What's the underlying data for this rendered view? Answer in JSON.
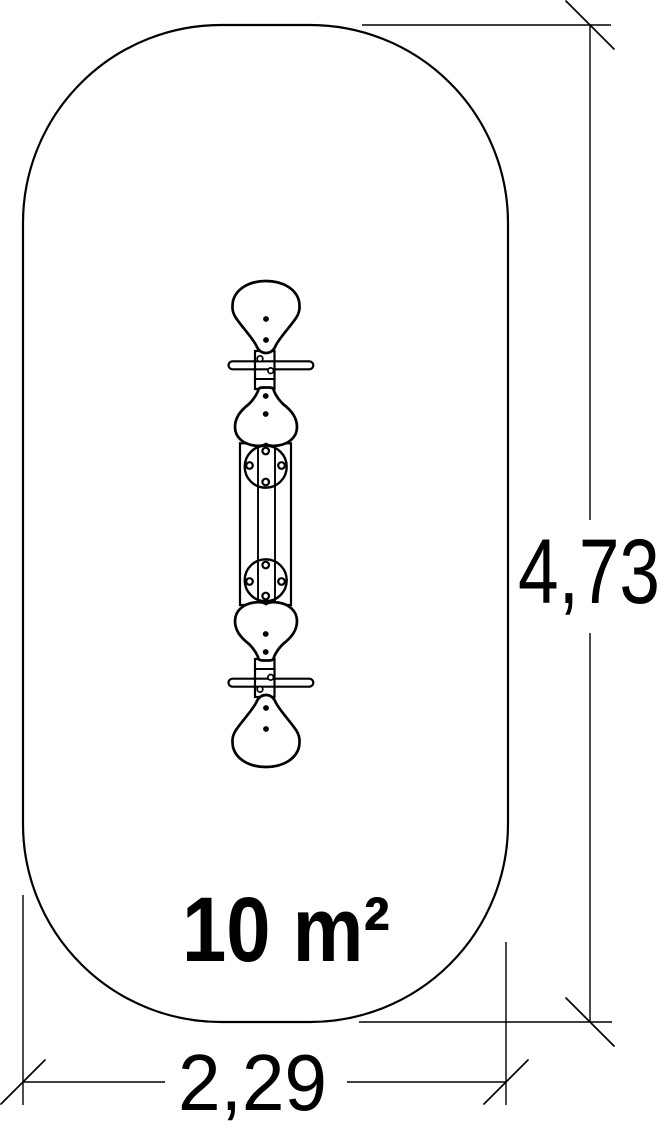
{
  "drawing": {
    "kind": "playground-equipment-footprint-plan",
    "area": {
      "label": "10 m²"
    },
    "dimensions": {
      "height": {
        "label": "4,73"
      },
      "width": {
        "label": "2,29"
      }
    },
    "equipment": {
      "name": "spring-seesaw-top-view",
      "parts": {
        "seat": "seat",
        "handlebar": "handlebar",
        "spring_frame": "spring-frame"
      }
    },
    "colors": {
      "line": "#000000",
      "background": "#ffffff"
    }
  }
}
